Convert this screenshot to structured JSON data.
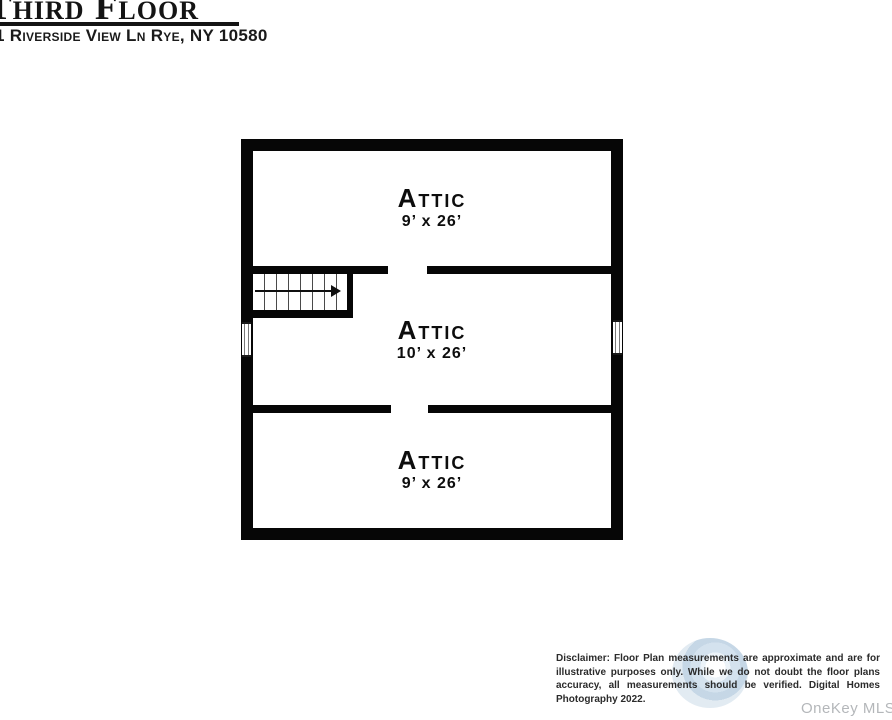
{
  "header": {
    "title": "Third Floor",
    "address": "1 Riverside View Ln Rye, NY 10580"
  },
  "floor_plan": {
    "rooms": [
      {
        "name": "Attic",
        "dimensions": "9’ x 26’"
      },
      {
        "name": "Attic",
        "dimensions": "10’ x 26’"
      },
      {
        "name": "Attic",
        "dimensions": "9’ x 26’"
      }
    ],
    "stair_icon": "stair-direction-arrow-right",
    "window_count": 2,
    "door_openings": 2
  },
  "footer": {
    "disclaimer": "Disclaimer: Floor Plan measurements are approximate and are for illustrative purposes only. While we do not doubt the floor plans accuracy, all measurements should be verified. Digital Homes Photography 2022.",
    "mls_label": "OneKey MLS"
  },
  "colors": {
    "wall": "#060606",
    "text": "#111111",
    "disclaimer_text": "#2b2b2b",
    "mls_text": "#b4b7ba",
    "logo_blue": "#c9dbea"
  }
}
